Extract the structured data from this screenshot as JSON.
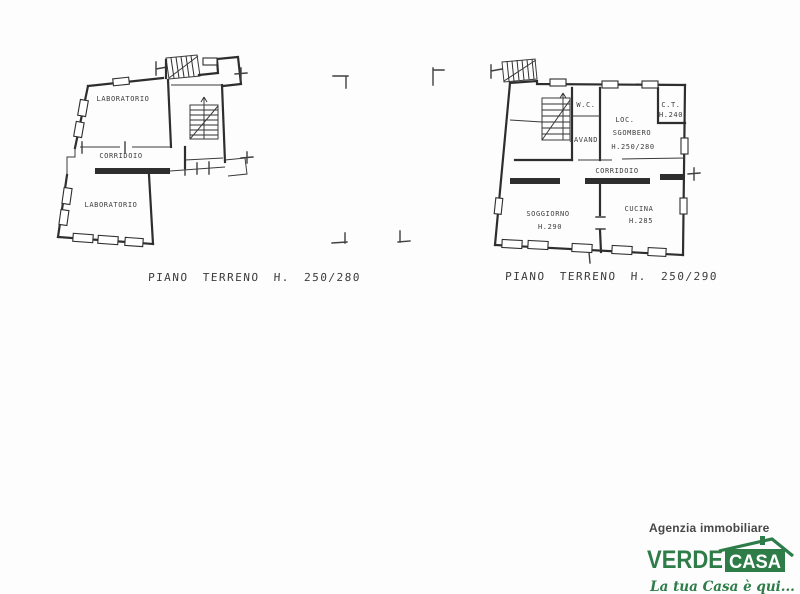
{
  "plans": [
    {
      "caption": "PIANO TERRENO H. 250/280",
      "rooms": {
        "lab_top": "LABORATORIO",
        "corridoio": "CORRIDOIO",
        "lab_bottom": "LABORATORIO"
      }
    },
    {
      "caption": "PIANO TERRENO H. 250/290",
      "rooms": {
        "wc": "W.C.",
        "lavanderia": "LAVAND.",
        "loc_line1": "LOC.",
        "loc_line2": "SGOMBERO",
        "loc_line3": "H.250/280",
        "ct_line1": "C.T.",
        "ct_line2": "H.240",
        "corridoio": "CORRIDOIO",
        "soggiorno": "SOGGIORNO",
        "soggiorno_h": "H.290",
        "cucina": "CUCINA",
        "cucina_h": "H.285"
      }
    }
  ],
  "logo": {
    "line1": "Agenzia immobiliare",
    "brand_left": "VERDE",
    "brand_right": "CASA",
    "tagline": "La tua Casa è qui...",
    "colors": {
      "green": "#2E7D49",
      "text_dark": "#474747"
    }
  }
}
